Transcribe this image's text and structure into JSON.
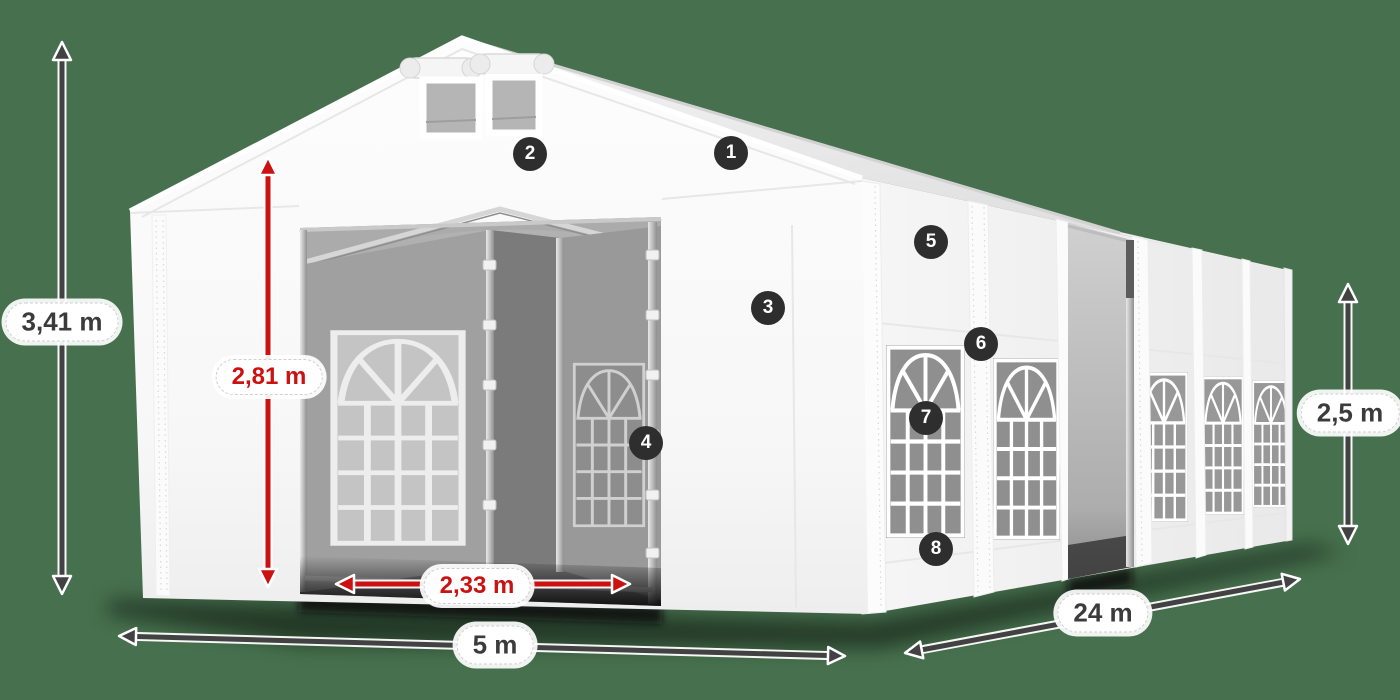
{
  "colors": {
    "background": "#47714E",
    "dimension_gray": "#424242",
    "dimension_red": "#cc1111",
    "badge_background": "#2e2e2e",
    "badge_text": "#ffffff",
    "label_text": "#3b3b3b",
    "label_background": "#ffffff"
  },
  "dimensions": {
    "total_height": {
      "value": "3,41 m",
      "style": "gray"
    },
    "entrance_height": {
      "value": "2,81 m",
      "style": "red"
    },
    "entrance_width": {
      "value": "2,33 m",
      "style": "red"
    },
    "front_width": {
      "value": "5 m",
      "style": "gray"
    },
    "side_length": {
      "value": "24 m",
      "style": "gray"
    },
    "side_height": {
      "value": "2,5 m",
      "style": "gray"
    }
  },
  "callouts": [
    {
      "number": "1"
    },
    {
      "number": "2"
    },
    {
      "number": "3"
    },
    {
      "number": "4"
    },
    {
      "number": "5"
    },
    {
      "number": "6"
    },
    {
      "number": "7"
    },
    {
      "number": "8"
    }
  ]
}
